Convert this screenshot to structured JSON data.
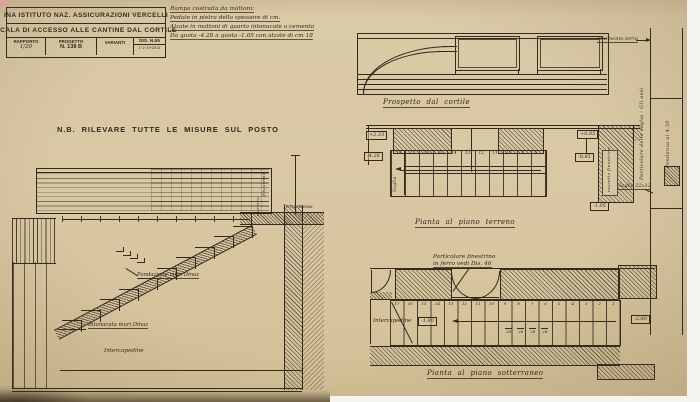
{
  "colors": {
    "paper": "#d7c6a2",
    "ink": "#33291d",
    "white_margin": "#f6f4ee"
  },
  "title_block": {
    "row1": "INA ISTITUTO NAZ. ASSICURAZIONI VERCELLI",
    "row2": "SCALA DI ACCESSO ALLE CANTINE DAL CORTILE",
    "rapporto_label": "RAPPORTO",
    "rapporto_value": "1/20",
    "progetto_label": "PROGETTO",
    "progetto_value": "N. 138 B",
    "varianti_label": "VARIANTI",
    "dis_number": "DIS. N.55",
    "dis_date": "1-2-39-XVII"
  },
  "spec_note": {
    "lines": [
      "Rampa costruita da mattoni:",
      "Pedate in pietra dello spessore di cm.",
      "Alzate in mattoni di quarto intonacate a cemento",
      "Da quota -4.28 a quota -1.05 con alzate di cm 18"
    ]
  },
  "nb_note": "N.B. RILEVARE TUTTE LE MISURE SUL POSTO",
  "section": {
    "fondazione": "Fondazione muri Dinaz",
    "intonacata": "Intonacata muri Dinaz",
    "intercapedine": "Intercapedine",
    "terra_smossa": "Terra smossa",
    "finestrino": "finestrino",
    "muretto": "muretto"
  },
  "prospetto": {
    "caption": "Prospetto dal cortile"
  },
  "pianta_terreno": {
    "caption": "Pianta al piano terreno",
    "steps": [
      "18",
      "17",
      "16",
      "15",
      "14",
      "13",
      "12",
      "11",
      "10",
      "9",
      "8"
    ],
    "quota_top_left": "+2.23",
    "quota_bottom_left": "-4.28",
    "quota_top_right": "+0.85",
    "quota_mid_right": "-0.85",
    "quota_bottom_right": "-1.05",
    "soglia": "Soglia",
    "muretto_finestrino": "muretto finestrino"
  },
  "pianta_sotterraneo": {
    "caption": "Pianta al piano sotterraneo",
    "detail_note_line1": "Particolare finestrino",
    "detail_note_line2": "in ferro vedi Dis. 46",
    "intercapedine": "Intercapedine",
    "quota_left": "-1.80",
    "quota_right": "-2.80",
    "steps": [
      "17",
      "16",
      "15",
      "14",
      "13",
      "12",
      "11",
      "10",
      "9",
      "8",
      "7",
      "6",
      "5",
      "4",
      "3",
      "2",
      "1"
    ],
    "tread_dims": [
      "28",
      "28",
      "28",
      "28"
    ]
  },
  "right_margin": {
    "pavimento": "Pavimento terra",
    "particolare_soglia": "Particolare della soglia - Gli assi",
    "pendenza": "Pendenza al 4.50",
    "soglia_dim": "Soglia 22x12"
  }
}
